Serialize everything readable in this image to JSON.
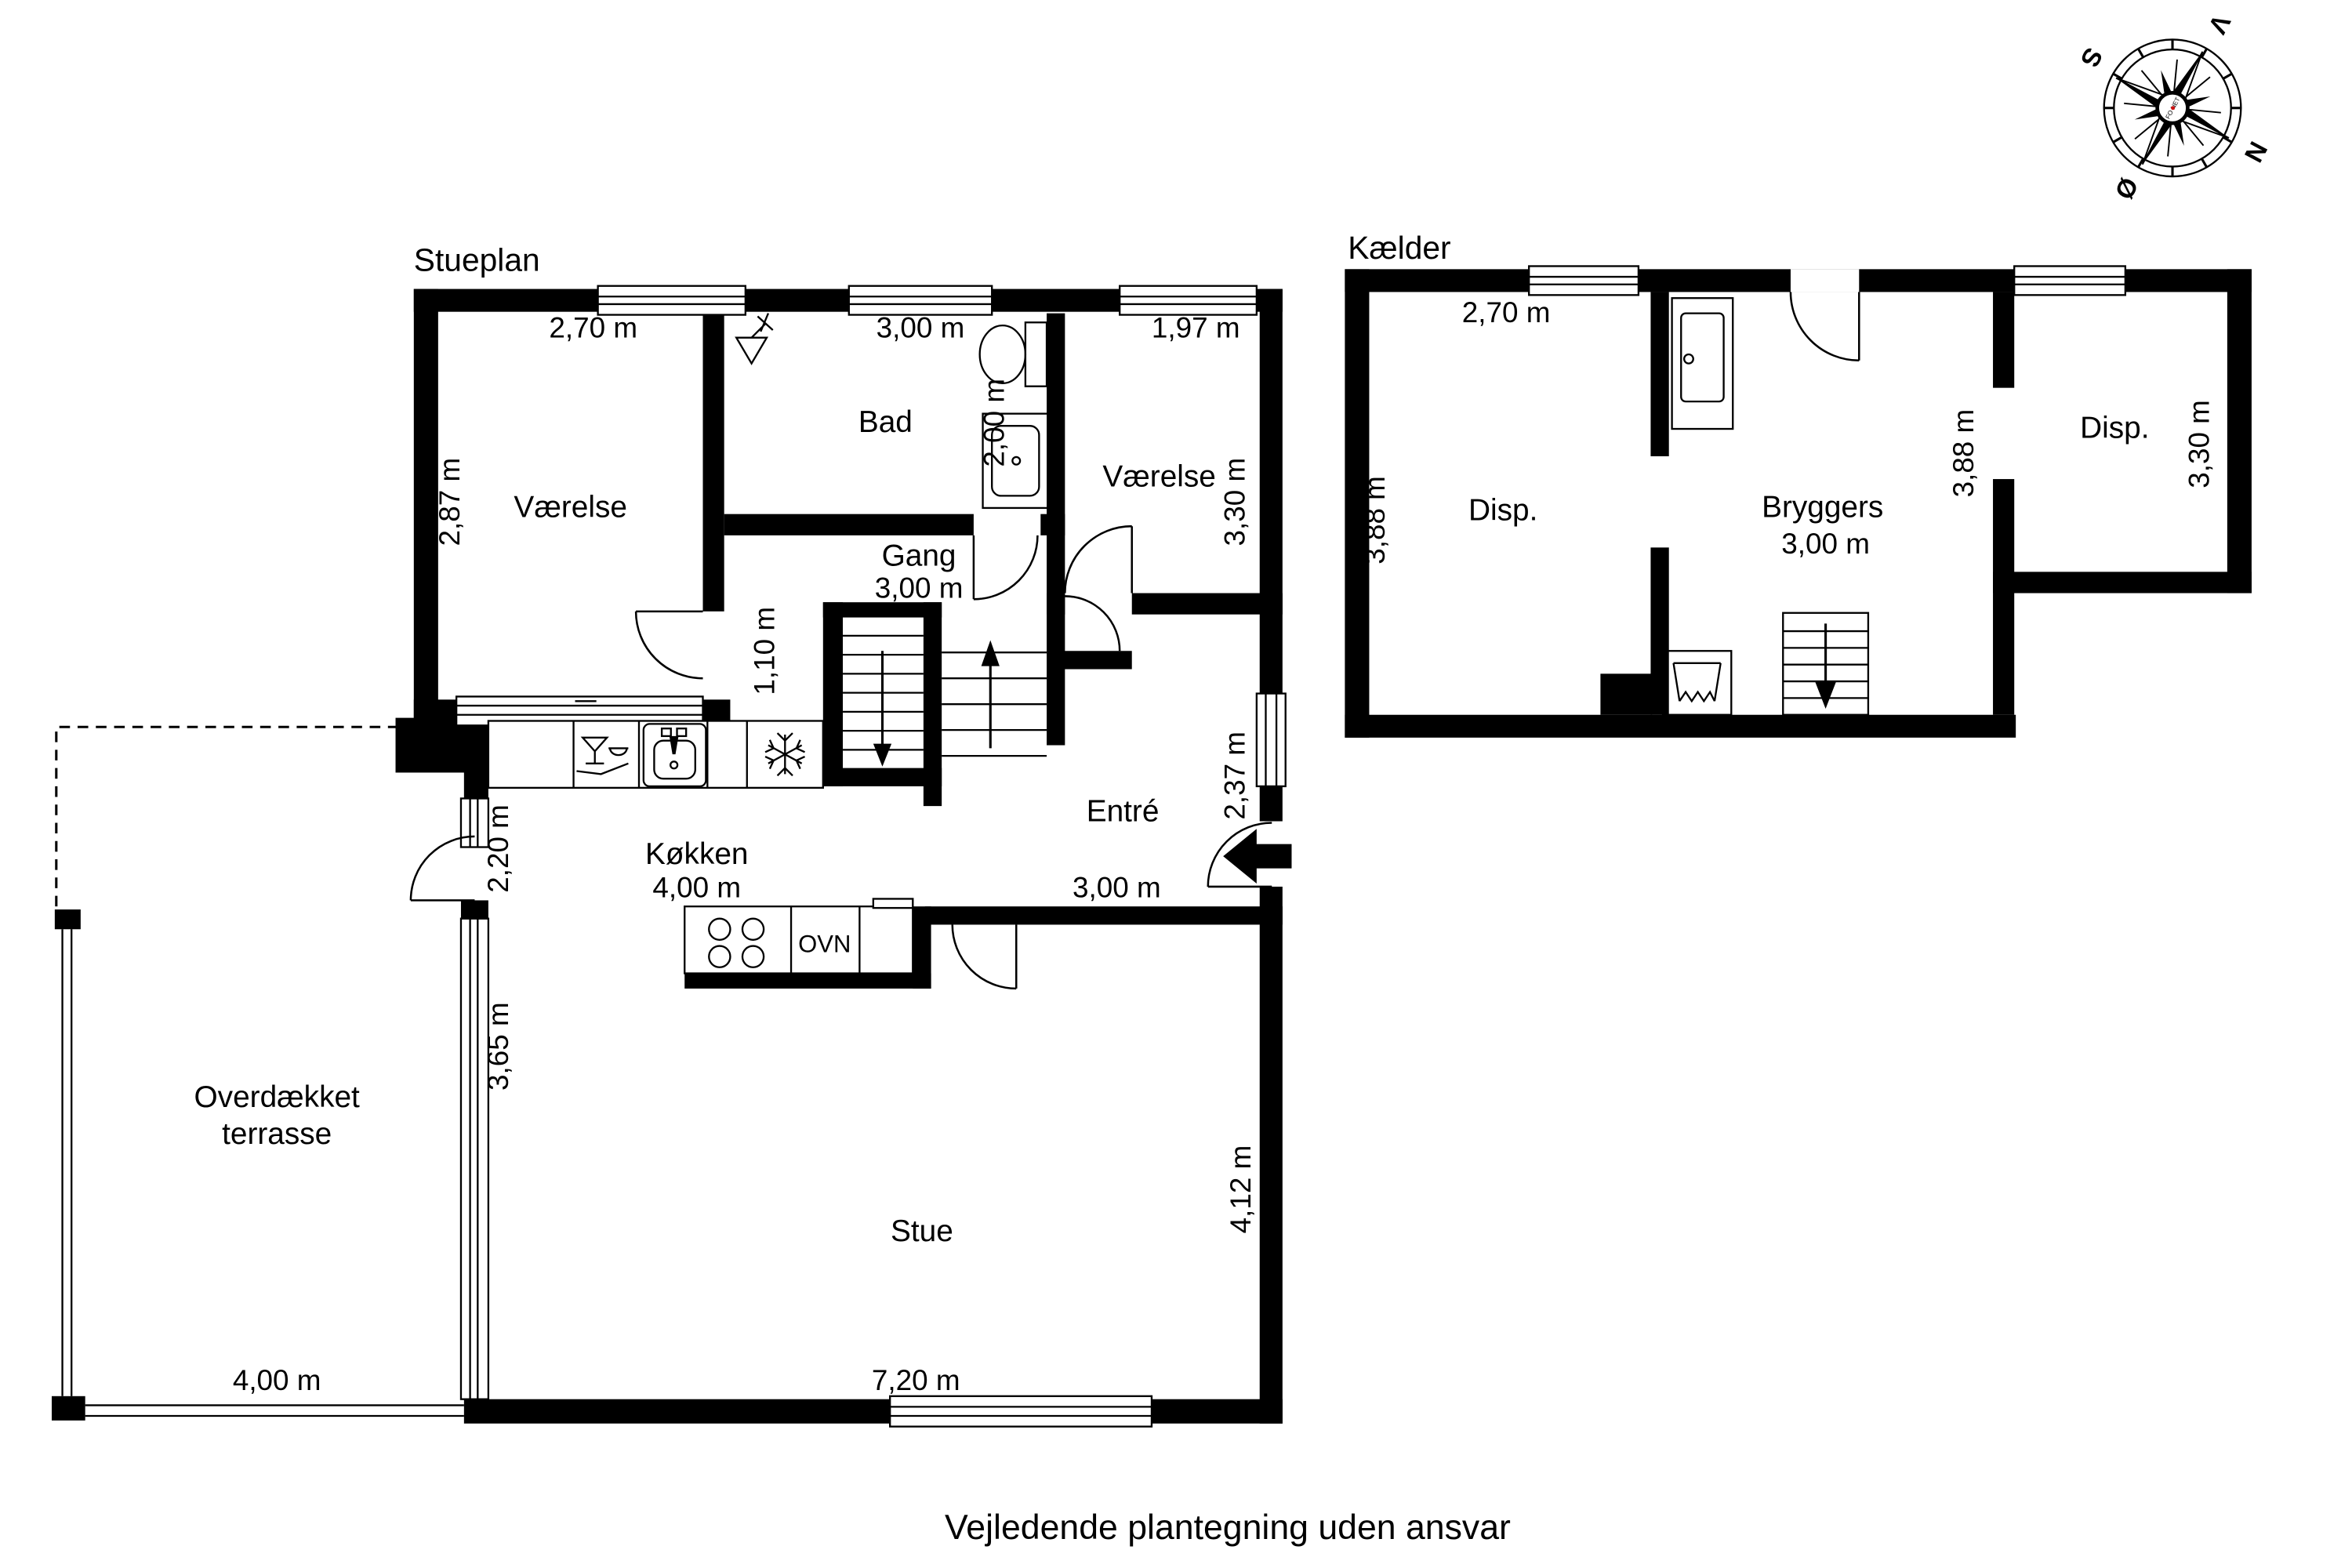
{
  "page": {
    "disclaimer": "Vejledende plantegning uden ansvar"
  },
  "compass": {
    "north_label": "N",
    "south_label": "S",
    "west_label": "V",
    "east_label": "Ø",
    "center_text": "FO NET",
    "accent_color": "#cc1111"
  },
  "stueplan": {
    "title": "Stueplan",
    "bedroom_left": {
      "name": "Værelse",
      "width": "2,70 m",
      "depth": "2,87 m"
    },
    "bathroom": {
      "name": "Bad",
      "width": "3,00 m",
      "depth": "2,00 m"
    },
    "bedroom_right": {
      "name": "Værelse",
      "width": "1,97 m",
      "depth": "3,30 m"
    },
    "hallway": {
      "name": "Gang",
      "width": "3,00 m",
      "passage_width": "1,10 m"
    },
    "entry": {
      "name": "Entré",
      "width": "3,00 m",
      "depth": "2,37 m"
    },
    "kitchen": {
      "name": "Køkken",
      "width": "4,00 m",
      "wall_section": "2,20 m",
      "oven_label": "OVN"
    },
    "living_room": {
      "name": "Stue",
      "width": "7,20 m",
      "depth_right": "4,12 m",
      "depth_left": "3,65 m"
    },
    "terrace": {
      "name_line1": "Overdækket",
      "name_line2": "terrasse",
      "width": "4,00 m"
    }
  },
  "kaelder": {
    "title": "Kælder",
    "storage_left": {
      "name": "Disp.",
      "width": "2,70 m",
      "depth": "3,88 m"
    },
    "utility": {
      "name": "Bryggers",
      "width": "3,00 m",
      "depth": "3,88 m"
    },
    "storage_right": {
      "name": "Disp.",
      "depth": "3,30 m"
    }
  }
}
